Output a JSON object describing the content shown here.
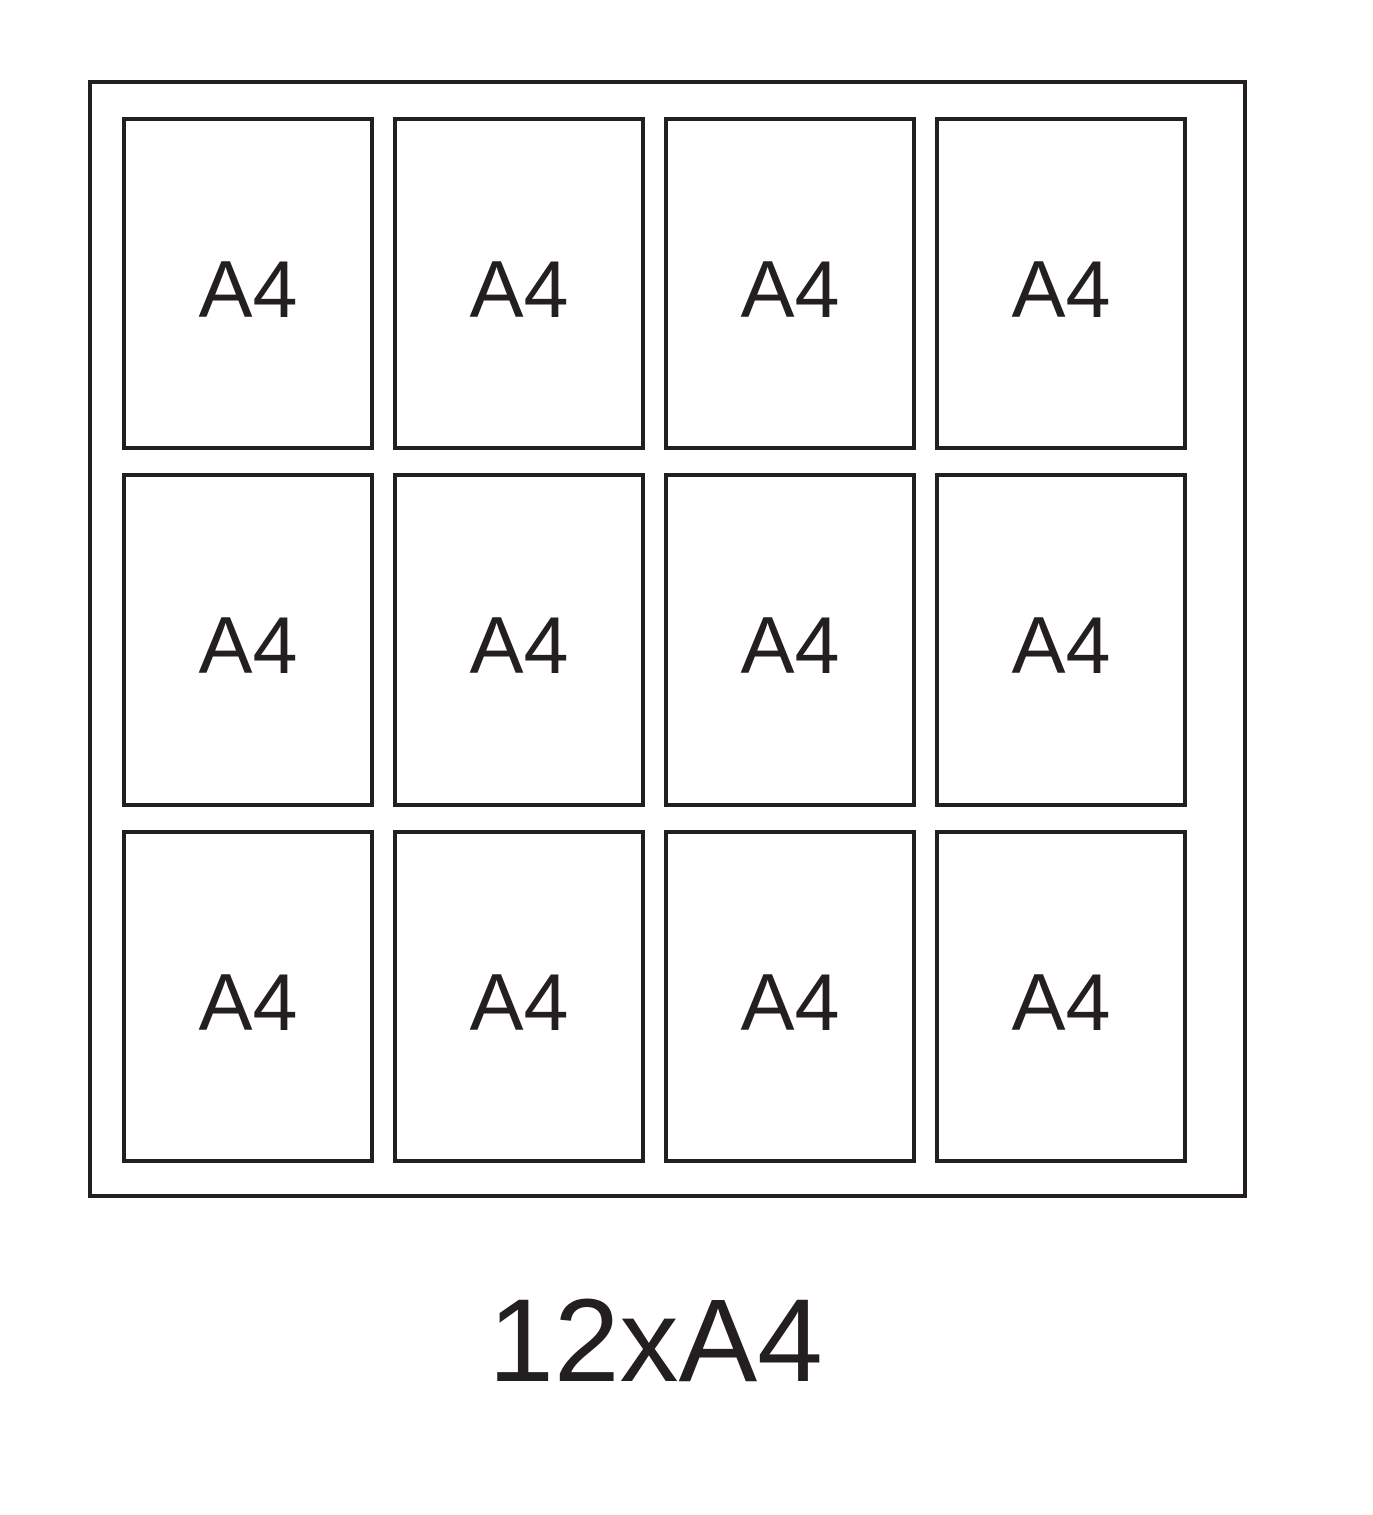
{
  "diagram": {
    "caption": "12xA4",
    "grid": {
      "rows": 3,
      "columns": 4,
      "count": 12,
      "sheet_label": "A4"
    },
    "cells": [
      {
        "label": "A4"
      },
      {
        "label": "A4"
      },
      {
        "label": "A4"
      },
      {
        "label": "A4"
      },
      {
        "label": "A4"
      },
      {
        "label": "A4"
      },
      {
        "label": "A4"
      },
      {
        "label": "A4"
      },
      {
        "label": "A4"
      },
      {
        "label": "A4"
      },
      {
        "label": "A4"
      },
      {
        "label": "A4"
      }
    ],
    "colors": {
      "line": "#231f20",
      "background": "#ffffff"
    }
  }
}
